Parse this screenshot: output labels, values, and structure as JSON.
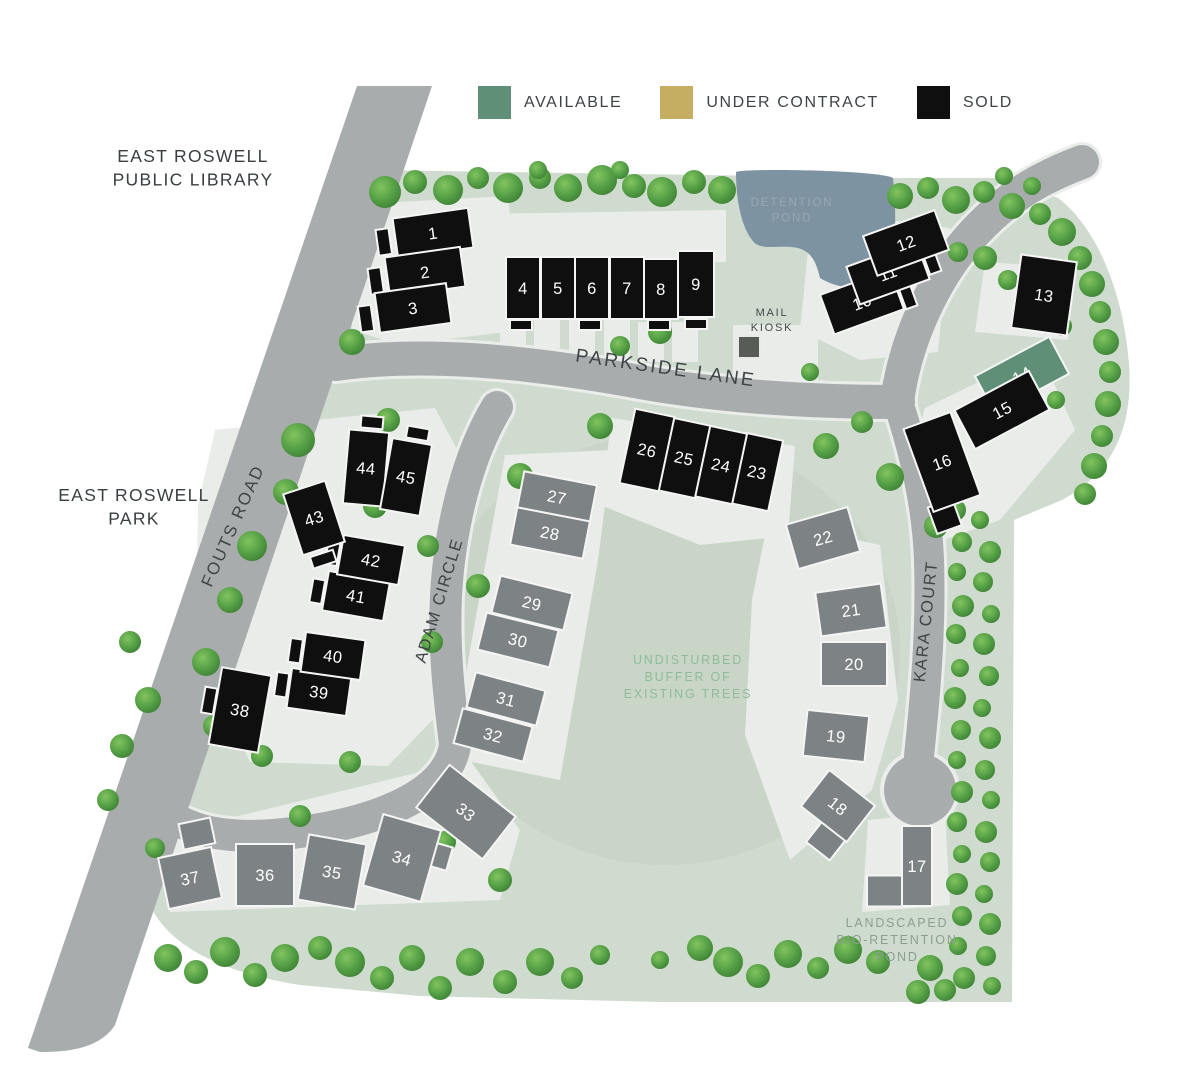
{
  "legend": {
    "items": [
      {
        "label": "AVAILABLE",
        "status": "available"
      },
      {
        "label": "UNDER CONTRACT",
        "status": "under_contract"
      },
      {
        "label": "SOLD",
        "status": "sold"
      }
    ]
  },
  "colors": {
    "available": "#5f9077",
    "under_contract": "#c5ad62",
    "sold": "#0f0f0f",
    "future": "#7d8284",
    "site_green": "#cfdbce",
    "buffer_green": "#c7d4c6",
    "road_gray": "#a8acac",
    "pond_blue": "#7e93a2",
    "driveway": "#e9ece8"
  },
  "map": {
    "landmarks": [
      {
        "id": "library",
        "lines": [
          "EAST ROSWELL",
          "PUBLIC LIBRARY"
        ],
        "x": 193,
        "y": 162
      },
      {
        "id": "park",
        "lines": [
          "EAST ROSWELL",
          "PARK"
        ],
        "x": 134,
        "y": 501
      }
    ],
    "roads": [
      {
        "id": "parkside-lane",
        "label": "PARKSIDE LANE",
        "x": 665,
        "y": 374,
        "rot": 8,
        "size": 19,
        "ls": 2.5
      },
      {
        "id": "fouts-road",
        "label": "FOUTS ROAD",
        "x": 238,
        "y": 528,
        "rot": -66,
        "size": 17,
        "ls": 2
      },
      {
        "id": "adam-circle",
        "label": "ADAM CIRCLE",
        "x": 444,
        "y": 602,
        "rot": -73,
        "size": 16.5,
        "ls": 1.5
      },
      {
        "id": "kara-court",
        "label": "KARA COURT",
        "x": 931,
        "y": 622,
        "rot": -84,
        "size": 16.5,
        "ls": 1.5
      }
    ],
    "notes": [
      {
        "id": "detention-pond-label",
        "lines": [
          "DETENTION",
          "POND"
        ],
        "x": 792,
        "y": 206,
        "color": "#96a8b2",
        "size": 11.5
      },
      {
        "id": "mail-kiosk-label",
        "lines": [
          "MAIL",
          "KIOSK"
        ],
        "x": 772,
        "y": 316,
        "color": "#45494c",
        "size": 11
      },
      {
        "id": "buffer-label",
        "lines": [
          "UNDISTURBED",
          "BUFFER OF",
          "EXISTING TREES"
        ],
        "x": 688,
        "y": 664,
        "color": "#8fbb9d",
        "size": 12.5
      },
      {
        "id": "bio-pond-label",
        "lines": [
          "LANDSCAPED",
          "BIO-RETENTION",
          "POND"
        ],
        "x": 897,
        "y": 927,
        "color": "#8d9e90",
        "size": 12.5
      }
    ],
    "lots": [
      {
        "num": "1",
        "status": "sold",
        "x": 433,
        "y": 233,
        "w": 76,
        "h": 40,
        "rot": -8,
        "foot": {
          "dx": -50,
          "dy": 2,
          "w": 13,
          "h": 26
        }
      },
      {
        "num": "2",
        "status": "sold",
        "x": 425,
        "y": 272,
        "w": 76,
        "h": 40,
        "rot": -8,
        "foot": {
          "dx": -50,
          "dy": 2,
          "w": 13,
          "h": 26
        }
      },
      {
        "num": "3",
        "status": "sold",
        "x": 413,
        "y": 308,
        "w": 72,
        "h": 40,
        "rot": -8,
        "foot": {
          "dx": -48,
          "dy": 4,
          "w": 13,
          "h": 26
        }
      },
      {
        "num": "4",
        "status": "sold",
        "x": 523,
        "y": 288,
        "w": 34,
        "h": 62,
        "rot": 0,
        "foot": {
          "dx": -2,
          "dy": 37,
          "w": 22,
          "h": 10
        }
      },
      {
        "num": "5",
        "status": "sold",
        "x": 558,
        "y": 288,
        "w": 34,
        "h": 62,
        "rot": 0
      },
      {
        "num": "6",
        "status": "sold",
        "x": 592,
        "y": 288,
        "w": 34,
        "h": 62,
        "rot": 0,
        "foot": {
          "dx": -2,
          "dy": 37,
          "w": 22,
          "h": 10
        }
      },
      {
        "num": "7",
        "status": "sold",
        "x": 627,
        "y": 288,
        "w": 34,
        "h": 62,
        "rot": 0
      },
      {
        "num": "8",
        "status": "sold",
        "x": 661,
        "y": 289,
        "w": 34,
        "h": 60,
        "rot": 0,
        "foot": {
          "dx": -2,
          "dy": 36,
          "w": 22,
          "h": 10
        }
      },
      {
        "num": "9",
        "status": "sold",
        "x": 696,
        "y": 284,
        "w": 36,
        "h": 66,
        "rot": 0,
        "foot": {
          "dx": 0,
          "dy": 40,
          "w": 22,
          "h": 10
        }
      },
      {
        "num": "10",
        "status": "sold",
        "x": 862,
        "y": 302,
        "w": 74,
        "h": 42,
        "rot": -20,
        "foot": {
          "dx": 45,
          "dy": 10,
          "w": 12,
          "h": 24
        }
      },
      {
        "num": "11",
        "status": "sold",
        "x": 888,
        "y": 273,
        "w": 74,
        "h": 40,
        "rot": -20,
        "foot": {
          "dx": 45,
          "dy": 4,
          "w": 12,
          "h": 24
        }
      },
      {
        "num": "12",
        "status": "sold",
        "x": 906,
        "y": 243,
        "w": 76,
        "h": 42,
        "rot": -20
      },
      {
        "num": "13",
        "status": "sold",
        "x": 1044,
        "y": 295,
        "w": 56,
        "h": 74,
        "rot": 8
      },
      {
        "num": "14",
        "status": "available",
        "x": 1022,
        "y": 375,
        "w": 84,
        "h": 42,
        "rot": -28
      },
      {
        "num": "15",
        "status": "sold",
        "x": 1002,
        "y": 410,
        "w": 84,
        "h": 44,
        "rot": -28
      },
      {
        "num": "16",
        "status": "sold",
        "x": 942,
        "y": 462,
        "w": 50,
        "h": 88,
        "rot": -20,
        "foot": {
          "dx": -16,
          "dy": 52,
          "w": 26,
          "h": 28
        }
      },
      {
        "num": "17",
        "status": "future",
        "x": 917,
        "y": 866,
        "w": 30,
        "h": 80,
        "rot": 0,
        "foot": {
          "dx": -19,
          "dy": 25,
          "w": 62,
          "h": 31
        }
      },
      {
        "num": "18",
        "status": "future",
        "x": 838,
        "y": 806,
        "w": 58,
        "h": 46,
        "rot": 38,
        "foot": {
          "dx": 12,
          "dy": 34,
          "w": 30,
          "h": 28
        }
      },
      {
        "num": "19",
        "status": "future",
        "x": 836,
        "y": 736,
        "w": 62,
        "h": 46,
        "rot": 6
      },
      {
        "num": "20",
        "status": "future",
        "x": 854,
        "y": 664,
        "w": 66,
        "h": 44,
        "rot": 0
      },
      {
        "num": "21",
        "status": "future",
        "x": 851,
        "y": 610,
        "w": 66,
        "h": 44,
        "rot": -8
      },
      {
        "num": "22",
        "status": "future",
        "x": 823,
        "y": 538,
        "w": 64,
        "h": 46,
        "rot": -16
      },
      {
        "num": "23",
        "status": "sold",
        "x": 757,
        "y": 472,
        "w": 38,
        "h": 72,
        "rot": 12
      },
      {
        "num": "24",
        "status": "sold",
        "x": 721,
        "y": 465,
        "w": 38,
        "h": 72,
        "rot": 12
      },
      {
        "num": "25",
        "status": "sold",
        "x": 684,
        "y": 458,
        "w": 38,
        "h": 74,
        "rot": 12
      },
      {
        "num": "26",
        "status": "sold",
        "x": 647,
        "y": 450,
        "w": 40,
        "h": 76,
        "rot": 12
      },
      {
        "num": "27",
        "status": "future",
        "x": 557,
        "y": 497,
        "w": 74,
        "h": 38,
        "rot": 11
      },
      {
        "num": "28",
        "status": "future",
        "x": 550,
        "y": 533,
        "w": 74,
        "h": 38,
        "rot": 11
      },
      {
        "num": "29",
        "status": "future",
        "x": 532,
        "y": 603,
        "w": 74,
        "h": 38,
        "rot": 14
      },
      {
        "num": "30",
        "status": "future",
        "x": 518,
        "y": 640,
        "w": 74,
        "h": 38,
        "rot": 14
      },
      {
        "num": "31",
        "status": "future",
        "x": 506,
        "y": 699,
        "w": 72,
        "h": 36,
        "rot": 15
      },
      {
        "num": "32",
        "status": "future",
        "x": 493,
        "y": 735,
        "w": 72,
        "h": 36,
        "rot": 15
      },
      {
        "num": "33",
        "status": "future",
        "x": 466,
        "y": 812,
        "w": 84,
        "h": 54,
        "rot": 38
      },
      {
        "num": "34",
        "status": "future",
        "x": 402,
        "y": 858,
        "w": 60,
        "h": 74,
        "rot": 16,
        "foot": {
          "dx": 36,
          "dy": -12,
          "w": 20,
          "h": 24
        }
      },
      {
        "num": "35",
        "status": "future",
        "x": 332,
        "y": 872,
        "w": 58,
        "h": 66,
        "rot": 10
      },
      {
        "num": "36",
        "status": "future",
        "x": 265,
        "y": 875,
        "w": 58,
        "h": 62,
        "rot": 0
      },
      {
        "num": "37",
        "status": "future",
        "x": 190,
        "y": 878,
        "w": 54,
        "h": 52,
        "rot": -12,
        "foot": {
          "dx": 16,
          "dy": -42,
          "w": 32,
          "h": 26
        }
      },
      {
        "num": "38",
        "status": "sold",
        "x": 240,
        "y": 710,
        "w": 50,
        "h": 78,
        "rot": 10,
        "foot": {
          "dx": -32,
          "dy": -4,
          "w": 12,
          "h": 26
        }
      },
      {
        "num": "39",
        "status": "sold",
        "x": 319,
        "y": 692,
        "w": 60,
        "h": 40,
        "rot": 8,
        "foot": {
          "dx": -38,
          "dy": -2,
          "w": 12,
          "h": 24
        }
      },
      {
        "num": "40",
        "status": "sold",
        "x": 333,
        "y": 656,
        "w": 60,
        "h": 40,
        "rot": 8,
        "foot": {
          "dx": -38,
          "dy": 0,
          "w": 12,
          "h": 24
        }
      },
      {
        "num": "41",
        "status": "sold",
        "x": 356,
        "y": 596,
        "w": 62,
        "h": 40,
        "rot": 10,
        "foot": {
          "dx": -39,
          "dy": 2,
          "w": 12,
          "h": 24
        }
      },
      {
        "num": "42",
        "status": "sold",
        "x": 371,
        "y": 560,
        "w": 62,
        "h": 40,
        "rot": 10,
        "foot": {
          "dx": -39,
          "dy": 0,
          "w": 12,
          "h": 24
        }
      },
      {
        "num": "43",
        "status": "sold",
        "x": 314,
        "y": 518,
        "w": 44,
        "h": 64,
        "rot": -18,
        "foot": {
          "dx": -4,
          "dy": 42,
          "w": 24,
          "h": 12
        }
      },
      {
        "num": "44",
        "status": "sold",
        "x": 366,
        "y": 468,
        "w": 40,
        "h": 74,
        "rot": 5,
        "foot": {
          "dx": 2,
          "dy": -46,
          "w": 22,
          "h": 12
        }
      },
      {
        "num": "45",
        "status": "sold",
        "x": 406,
        "y": 477,
        "w": 40,
        "h": 72,
        "rot": 10,
        "foot": {
          "dx": 4,
          "dy": -45,
          "w": 22,
          "h": 12
        }
      }
    ]
  }
}
